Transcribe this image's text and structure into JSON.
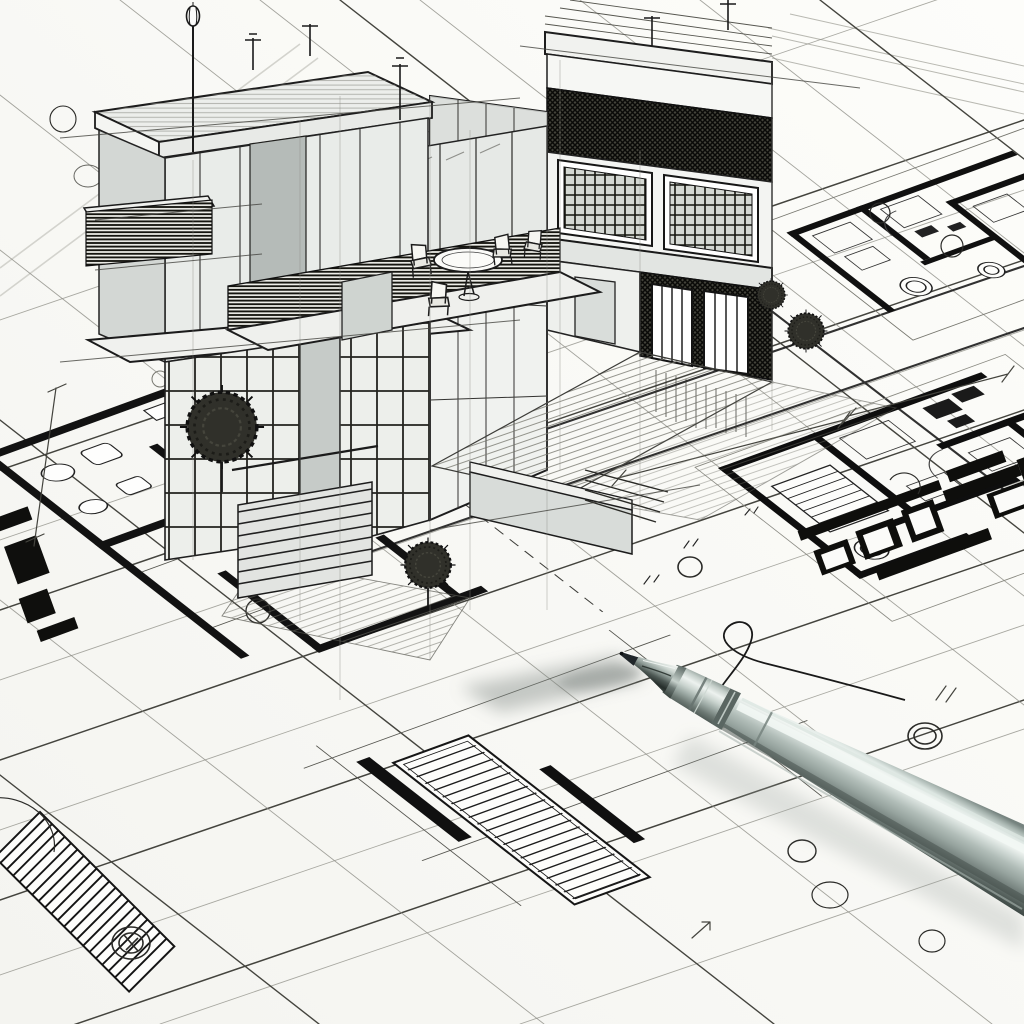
{
  "scene": {
    "kind": "architectural-sketch",
    "canvas": {
      "width": 1024,
      "height": 1024
    },
    "labels": {
      "canvas": "ink sketch of a modern two-story house rising in 3D from 2D blueprints, silver ballpoint pen resting on the paper",
      "paper": "white drafting paper",
      "grid": "perspective blueprint construction grid",
      "house": "two-story modern house ink sketch",
      "roof_deck": "roof deck with railing and pergola frame",
      "terrace": "second-floor terrace with round table and four chairs",
      "brick_facade": "cross-hatched dark brick facade bands",
      "entry_stairs": "entry steps beside a planter wall",
      "courtyard": "hatched paved courtyard",
      "floor_plan_left": "floor plan with hatched walls, bath fixtures and stair run",
      "floor_plan_top_right": "floor plan with black walls and tree circles",
      "floor_plan_right": "floor plan with stair run and dark furniture blocks",
      "floor_plan_bottom": "floor plan fragment with long striped stair run",
      "street_lamp": "street lamp on a thin pole",
      "antennas": "small T-shaped roof antennas",
      "vegetation": "round scribbled shrubs",
      "landscape_circles": "circular tree symbols drawn on the plans",
      "dimension_lines": "dimension lines with tick marks and illegible figures",
      "squiggle": "hand-drawn ink curl on the paper",
      "pen": "silver ballpoint pen",
      "pen_shadow": "soft cast shadow of the pen"
    },
    "palette": {
      "paper": "#fbfbf8",
      "ink": "#1b1b1b",
      "construction_line": "#8d8d86",
      "light_fill": "#eceeeb",
      "mid_gray": "#c6cbc8",
      "dark_panel": "#b5bbb8",
      "hatch_dark": "#43433a",
      "pen_highlight": "#f3f8f5",
      "pen_body": "#b1bdb8",
      "pen_dark": "#3e4945",
      "cast_shadow": "#7d8581"
    },
    "counts": {
      "floor_plans": 4,
      "shrubs": 4,
      "terrace_chairs": 4
    }
  }
}
